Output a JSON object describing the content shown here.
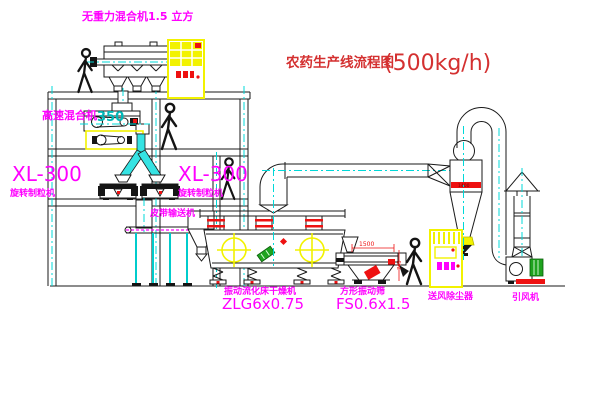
{
  "title": {
    "text": "农药生产线流程图",
    "capacity": "(500kg/h)"
  },
  "equipment_labels": {
    "zero_gravity_mixer": "无重力混合机1.5 立方",
    "high_speed_mixer": "高速混合机",
    "high_speed_mixer_size": "350",
    "granulator_left_model": "XL-300",
    "granulator_left_name": "旋转制粒机",
    "granulator_right_model": "XL-300",
    "granulator_right_name": "旋转制粒机",
    "belt_conveyor": "皮带输送机",
    "fluid_bed_dryer_name": "振动流化床干燥机",
    "fluid_bed_dryer_model": "ZLG6x0.75",
    "vibrating_sieve_name": "方形振动筛",
    "vibrating_sieve_model": "FS0.6x1.5",
    "dust_collector": "送风除尘器",
    "induced_draft_fan": "引风机"
  },
  "dimensions": {
    "sieve_width": "1500",
    "sieve_height": "745",
    "cyclone_marking": "1400"
  },
  "colors": {
    "label_magenta": "#ff00ff",
    "title_red": "#d43030",
    "centerline_cyan": "#00d8d8",
    "cabinet_yellow": "#f2f200",
    "accent_red": "#ee1111",
    "motor_green": "#1ea31e"
  }
}
